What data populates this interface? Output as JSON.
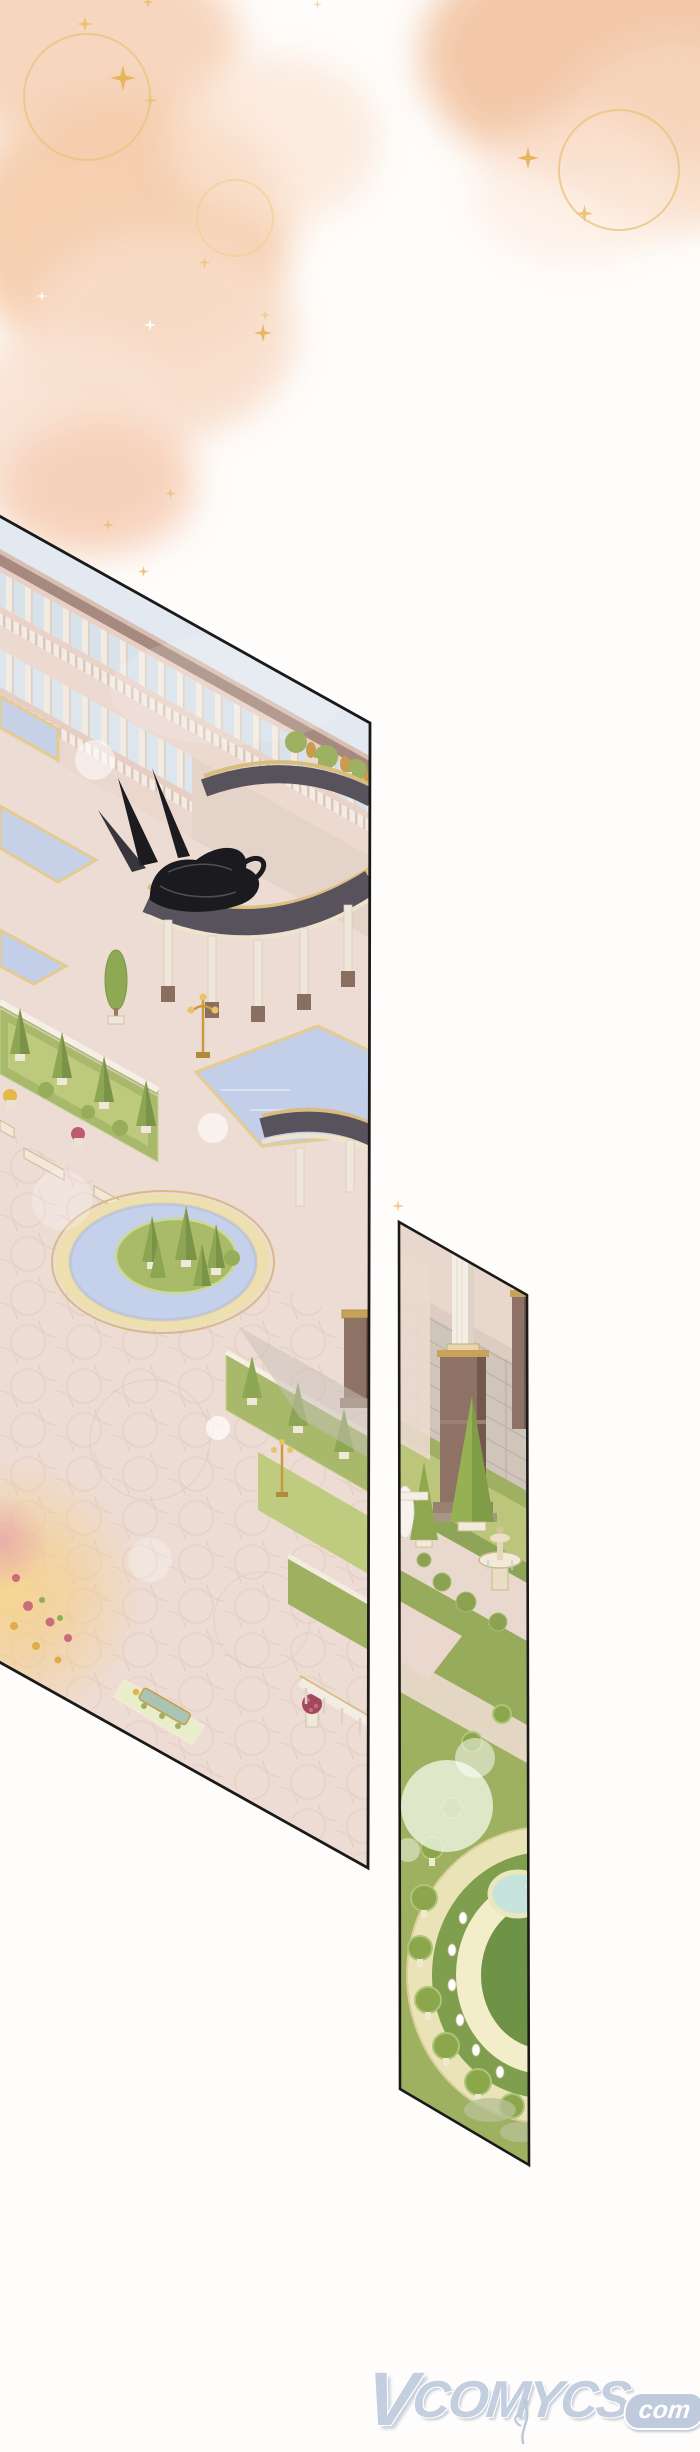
{
  "page": {
    "kind": "webtoon comic page",
    "background": "#fefdfb"
  },
  "top_decor": {
    "wash_color_light": "#fbe7d8",
    "wash_color_mid": "#f6d0b3",
    "wash_color_deep": "#f3c3a4",
    "ring_color": "#eac47e",
    "gold_sparkle_color": "#edc27a",
    "white_sparkle_color": "#ffffff"
  },
  "panels": [
    {
      "label": "wide garden panel",
      "border_color": "#1a1a1a",
      "scene": "Isometric royal palace garden: colonnade terraces, curved dark-roof pergolas, reflecting pools, circular pond with topiary island, hedge parterres with benches and urns, black bird sketch, golden light glow"
    },
    {
      "label": "narrow garden panel",
      "border_color": "#1a1a1a",
      "scene": "Vertical garden strip: stone wall with white column on brown pedestal, topiary beds with small fountain, large round tiered topiary fountain"
    }
  ],
  "watermark": {
    "site_initial": "V",
    "site_rest": "COMYCS",
    "suffix": "com",
    "color": "#bcc8db"
  }
}
